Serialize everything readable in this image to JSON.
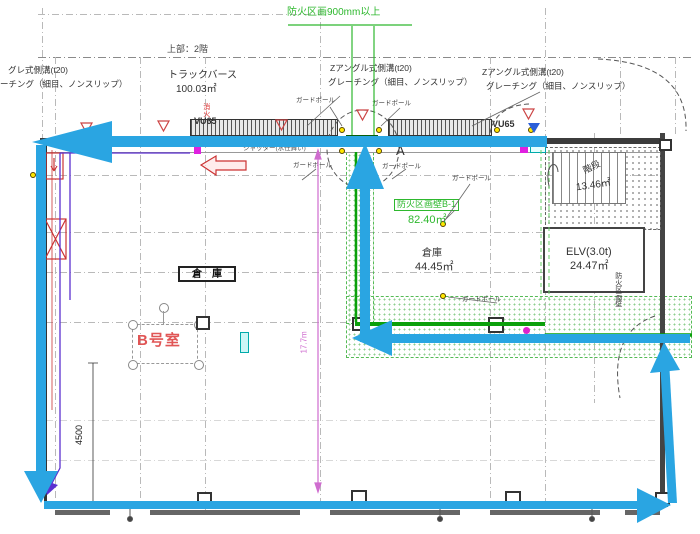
{
  "plan": {
    "top_note": "防火区画900mm以上",
    "upper_floor_note": "上部：2階",
    "gutters": {
      "left": {
        "line1": "グレ式側溝(t20)",
        "line2": "ーチング（細目、ノンスリップ）"
      },
      "center": {
        "line1": "Zアングル式側溝(t20)",
        "line2": "グレーチング（細目、ノンスリップ）"
      },
      "right": {
        "line1": "Zアングル式側溝(t20)",
        "line2": "グレーチング（細目、ノンスリップ）"
      }
    },
    "rooms": {
      "truck_berth": {
        "name": "トラックバース",
        "area": "100.03㎡"
      },
      "warehouse": {
        "name": "倉庫",
        "area": "44.45㎡"
      },
      "elevator": {
        "name": "ELV(3.0t)",
        "area": "24.47㎡"
      },
      "stairs": {
        "name": "階段",
        "area": "13.46㎡"
      },
      "storage_box": {
        "name": "倉　庫"
      },
      "room_b": {
        "name": "B号室"
      }
    },
    "annotations": {
      "vu65": "VU65",
      "fire_equipment": "消火",
      "shutter_note": "シャッター(水仕舞い)",
      "guard_pole": "ガードポール",
      "point_a": "A",
      "fire_partition_label": "防火区画壁B-1",
      "fire_partition_area": "82.40㎡",
      "fire_partition_wall": "防火区画壁",
      "dim_vertical": "17.7m",
      "dim_4500": "4500"
    },
    "colors": {
      "route_arrow": "#2aa5e2",
      "fire_green": "#2eb82e",
      "dim_pink": "#cf6ccf",
      "marker_red": "#cc3333"
    }
  }
}
